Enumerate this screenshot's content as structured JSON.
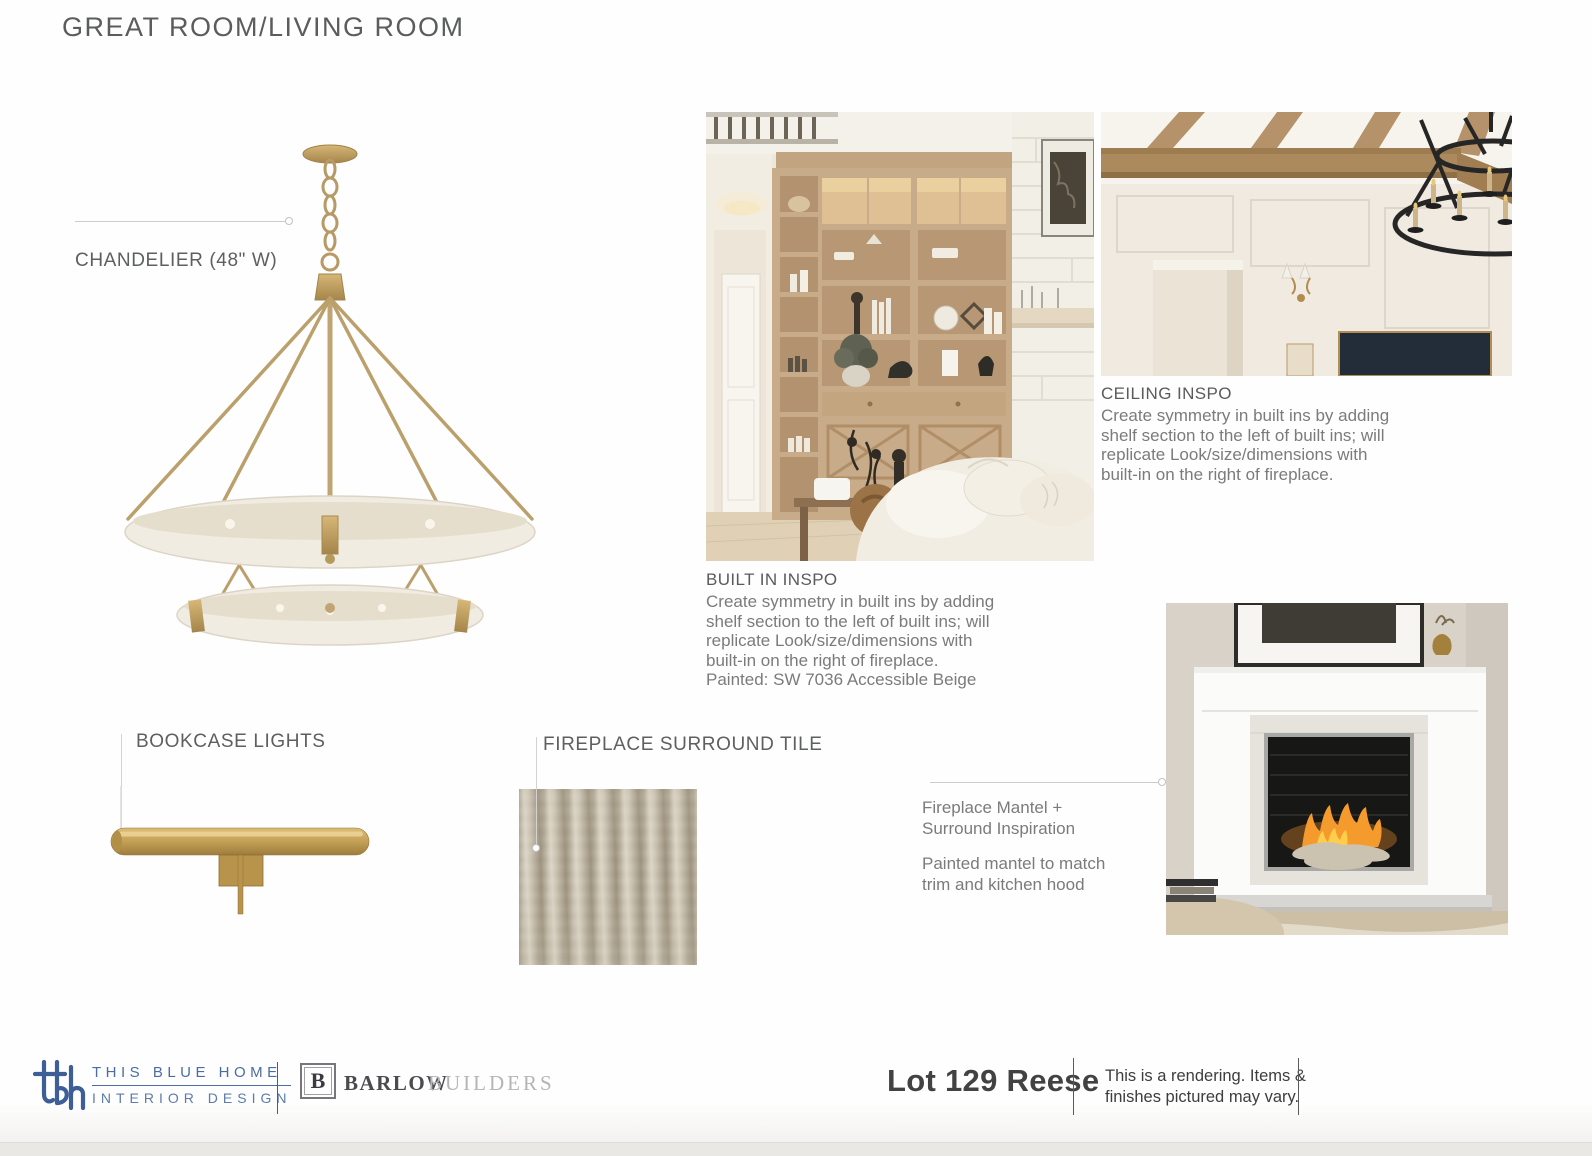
{
  "page": {
    "title": "GREAT ROOM/LIVING ROOM"
  },
  "chandelier": {
    "label": "CHANDELIER (48\" W)"
  },
  "built_in": {
    "heading": "BUILT IN INSPO",
    "lines": [
      "Create symmetry in built ins by adding",
      "shelf section to the left of built ins; will",
      "replicate Look/size/dimensions with",
      "built-in on the right of fireplace.",
      "Painted: SW 7036 Accessible Beige"
    ]
  },
  "ceiling": {
    "heading": "CEILING INSPO",
    "lines": [
      "Create symmetry in built ins by adding",
      "shelf section to the left of built ins; will",
      "replicate Look/size/dimensions with",
      "built-in on the right of fireplace."
    ]
  },
  "bookcase_lights": {
    "label": "BOOKCASE LIGHTS"
  },
  "fireplace_tile": {
    "label": "FIREPLACE SURROUND TILE"
  },
  "mantel": {
    "lines_a": [
      "Fireplace Mantel +",
      "Surround Inspiration"
    ],
    "lines_b": [
      "Painted mantel to match",
      "trim and kitchen hood"
    ]
  },
  "footer": {
    "brand_name": "THIS BLUE HOME",
    "brand_sub": "INTERIOR DESIGN",
    "builder_initial": "B",
    "builder_name": "BARLOW",
    "builder_suffix": "BUILDERS",
    "lot": "Lot 129 Reese",
    "disclaimer": [
      "This is a rendering. Items &",
      "finishes pictured may vary."
    ]
  },
  "colors": {
    "brass": "#b79a66",
    "logo_blue": "#4a6da3",
    "heading_gray": "#5a5b5d",
    "body_gray": "#7a7b7d",
    "leader_gray": "#cccccc"
  }
}
